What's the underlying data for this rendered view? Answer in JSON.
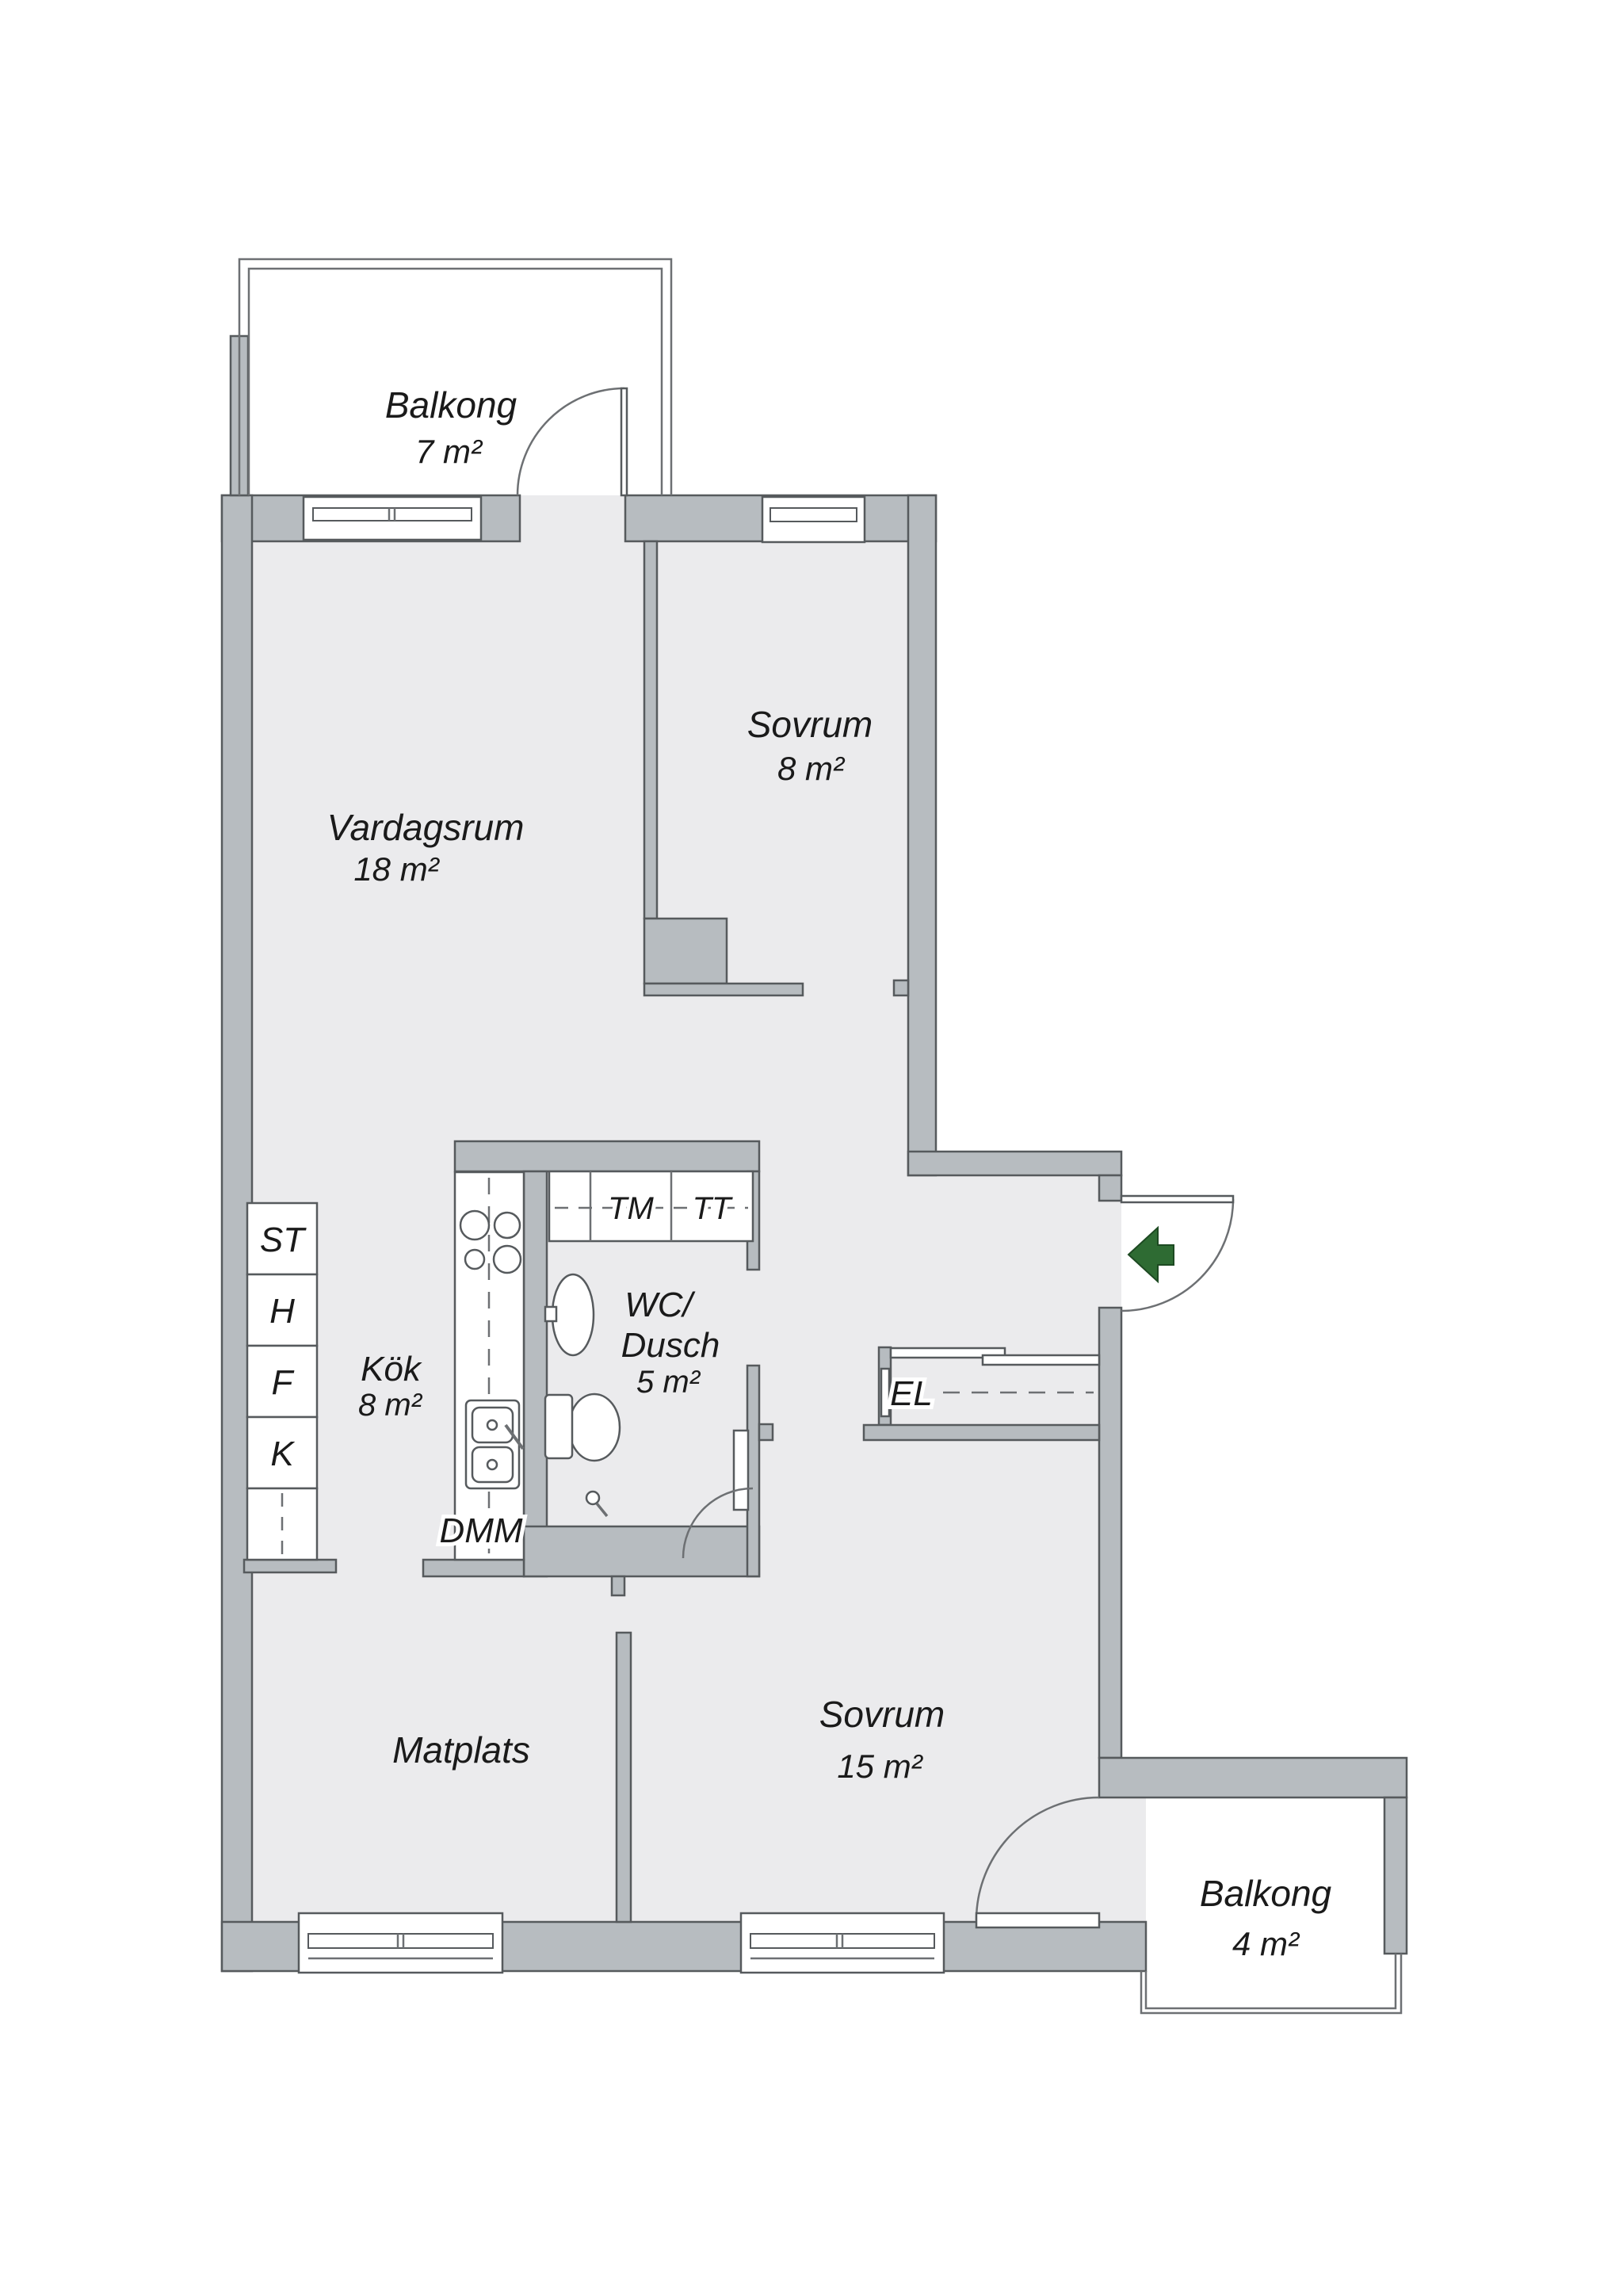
{
  "plan": {
    "palette": {
      "bg": "#ffffff",
      "floor": "#ebebed",
      "wall": "#b7bcc0",
      "outline": "#565a5d",
      "thin": "#6d7073",
      "green": "#2e6b33",
      "ink": "#1a1a1a"
    },
    "rooms": [
      {
        "id": "balkong-top",
        "name": "Balkong",
        "area": "7 m²"
      },
      {
        "id": "vardagsrum",
        "name": "Vardagsrum",
        "area": "18 m²"
      },
      {
        "id": "sovrum-8",
        "name": "Sovrum",
        "area": "8 m²"
      },
      {
        "id": "kok",
        "name": "Kök",
        "area": "8 m²"
      },
      {
        "id": "wc-dusch",
        "name": "WC/",
        "name2": "Dusch",
        "area": "5 m²"
      },
      {
        "id": "matplats",
        "name": "Matplats",
        "area": ""
      },
      {
        "id": "sovrum-15",
        "name": "Sovrum",
        "area": "15 m²"
      },
      {
        "id": "balkong-bottom",
        "name": "Balkong",
        "area": "4 m²"
      }
    ],
    "closet_labels": [
      "ST",
      "H",
      "F",
      "K"
    ],
    "appliance_labels": {
      "tm": "TM",
      "tt": "TT",
      "dmm": "DMM",
      "el": "EL"
    }
  }
}
